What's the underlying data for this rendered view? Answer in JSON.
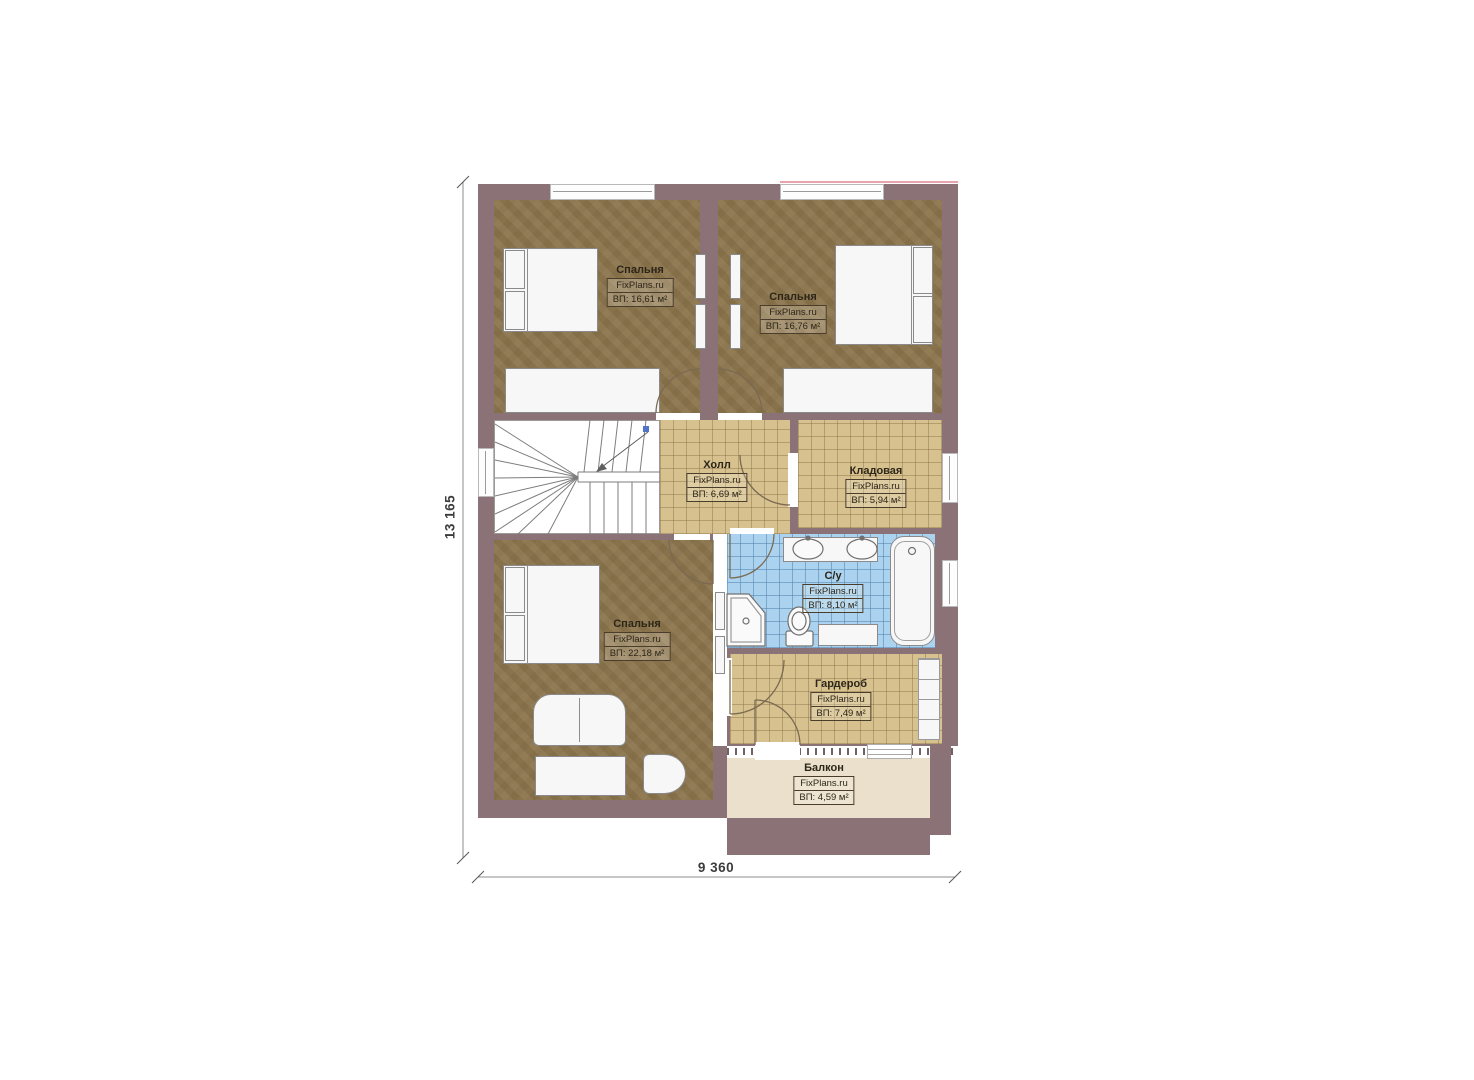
{
  "plan": {
    "site_watermark": "FixPlans.ru",
    "rooms": [
      {
        "id": "bedroom-top-left",
        "name": "Спальня",
        "brand": "FixPlans.ru",
        "area": "ВП: 16,61 м²"
      },
      {
        "id": "bedroom-top-right",
        "name": "Спальня",
        "brand": "FixPlans.ru",
        "area": "ВП: 16,76 м²"
      },
      {
        "id": "hall",
        "name": "Холл",
        "brand": "FixPlans.ru",
        "area": "ВП: 6,69 м²"
      },
      {
        "id": "storage",
        "name": "Кладовая",
        "brand": "FixPlans.ru",
        "area": "ВП: 5,94 м²"
      },
      {
        "id": "bathroom",
        "name": "С/у",
        "brand": "FixPlans.ru",
        "area": "ВП: 8,10 м²"
      },
      {
        "id": "bedroom-bottom",
        "name": "Спальня",
        "brand": "FixPlans.ru",
        "area": "ВП: 22,18 м²"
      },
      {
        "id": "wardrobe",
        "name": "Гардероб",
        "brand": "FixPlans.ru",
        "area": "ВП: 7,49 м²"
      },
      {
        "id": "balcony",
        "name": "Балкон",
        "brand": "FixPlans.ru",
        "area": "ВП: 4,59 м²"
      }
    ],
    "dimensions": {
      "height": "13 165",
      "width": "9 360"
    },
    "colors": {
      "wall": "#8b7277",
      "bedroom_floor": "#8d774f",
      "tile_floor": "#d6c18f",
      "bathroom_tile": "#abd3ef",
      "balcony_floor": "#eae0cb",
      "accent_pink": "#e8a3ad",
      "dimension_text": "#3c3c3c"
    }
  }
}
